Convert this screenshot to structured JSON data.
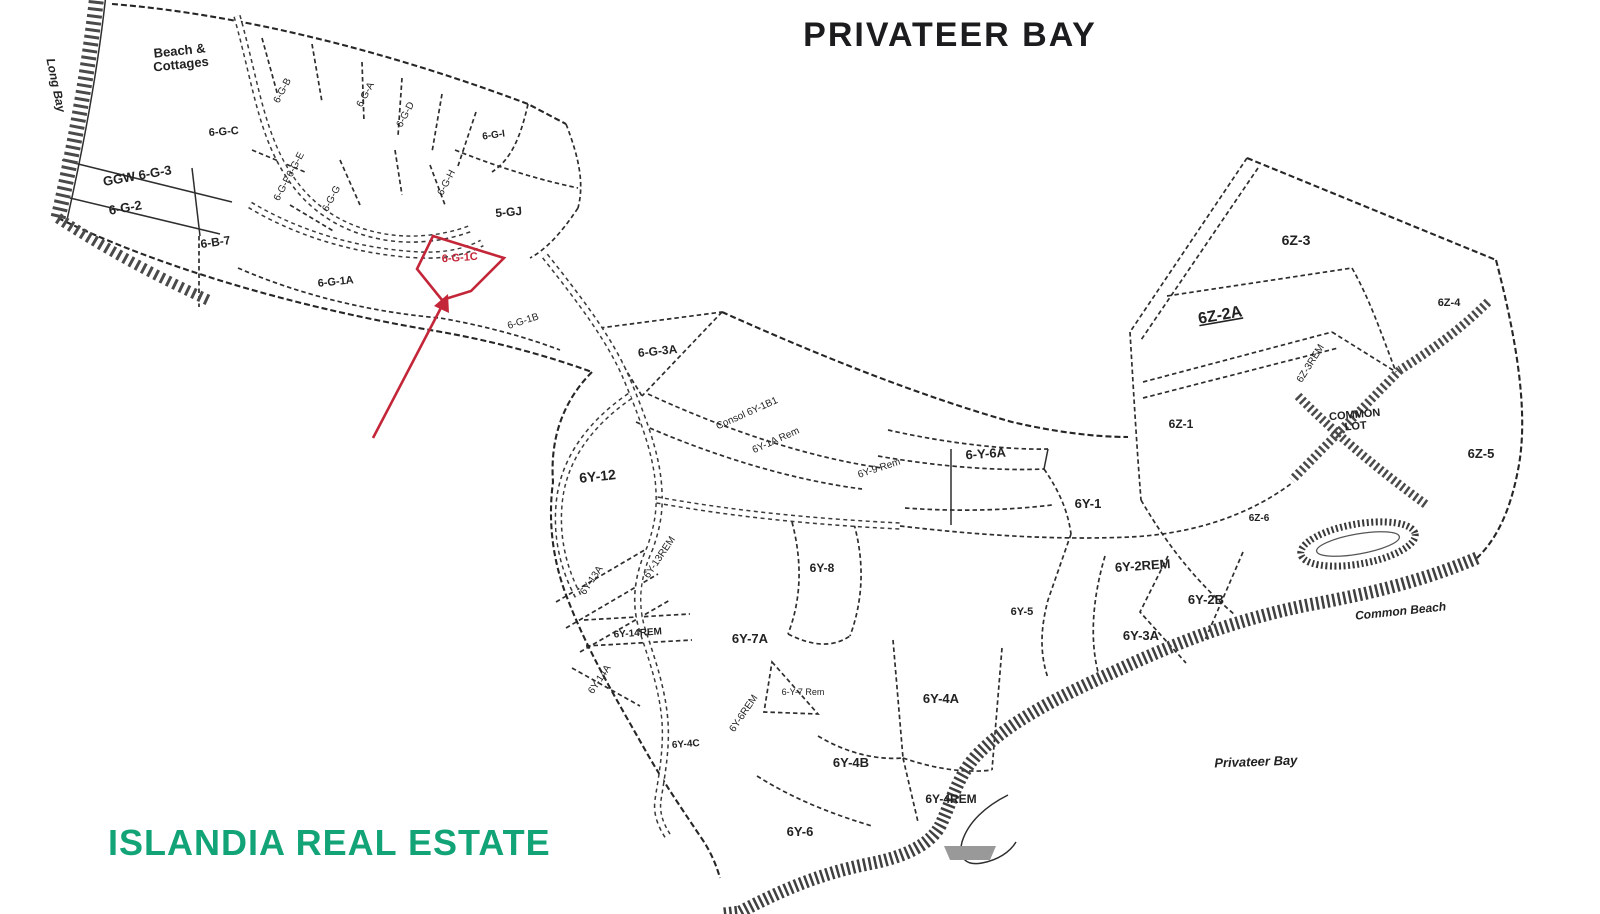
{
  "title": "PRIVATEER BAY",
  "credit": "ISLANDIA REAL ESTATE",
  "colors": {
    "credit_green": "#12A377",
    "highlight_red": "#C32638",
    "ink": "#222222"
  },
  "map": {
    "highlighted_lot": "6-G-1C",
    "labels": [
      {
        "text": "Long Bay",
        "x": 52,
        "y": 86,
        "rot": 78,
        "size": 12,
        "weight": 700,
        "style": "italic"
      },
      {
        "text": "Beach &\nCottages",
        "x": 180,
        "y": 55,
        "rot": -6,
        "size": 13,
        "weight": 700
      },
      {
        "text": "6-G-B",
        "x": 285,
        "y": 92,
        "rot": -62,
        "size": 10
      },
      {
        "text": "6-G-A",
        "x": 368,
        "y": 96,
        "rot": -62,
        "size": 10
      },
      {
        "text": "6-G-D",
        "x": 408,
        "y": 116,
        "rot": -62,
        "size": 10
      },
      {
        "text": "6-G-I",
        "x": 494,
        "y": 138,
        "rot": -8,
        "size": 10,
        "weight": 700
      },
      {
        "text": "6-G-C",
        "x": 224,
        "y": 135,
        "rot": -4,
        "size": 11,
        "weight": 700
      },
      {
        "text": "6-G-E",
        "x": 298,
        "y": 166,
        "rot": -62,
        "size": 10
      },
      {
        "text": "6-G-F",
        "x": 285,
        "y": 190,
        "rot": -62,
        "size": 10
      },
      {
        "text": "6-G-G",
        "x": 334,
        "y": 200,
        "rot": -62,
        "size": 10
      },
      {
        "text": "6-G-H",
        "x": 449,
        "y": 184,
        "rot": -62,
        "size": 10
      },
      {
        "text": "5-GJ",
        "x": 509,
        "y": 216,
        "rot": -5,
        "size": 12,
        "weight": 700
      },
      {
        "text": "GGW 6-G-3",
        "x": 138,
        "y": 180,
        "rot": -10,
        "size": 13,
        "weight": 700
      },
      {
        "text": "6-G-2",
        "x": 126,
        "y": 212,
        "rot": -10,
        "size": 13,
        "weight": 700
      },
      {
        "text": "6-B-7",
        "x": 216,
        "y": 246,
        "rot": -8,
        "size": 12,
        "weight": 700
      },
      {
        "text": "6-G-1A",
        "x": 336,
        "y": 285,
        "rot": -6,
        "size": 11,
        "weight": 700
      },
      {
        "text": "6-G-1C",
        "x": 460,
        "y": 261,
        "rot": -4,
        "size": 11,
        "weight": 700,
        "color": "#C32638"
      },
      {
        "text": "6-G-1B",
        "x": 524,
        "y": 324,
        "rot": -18,
        "size": 10
      },
      {
        "text": "6-G-3A",
        "x": 658,
        "y": 355,
        "rot": -6,
        "size": 12,
        "weight": 700
      },
      {
        "text": "Consol 6Y-1B1",
        "x": 748,
        "y": 416,
        "rot": -24,
        "size": 10
      },
      {
        "text": "6Y-1A Rem",
        "x": 777,
        "y": 443,
        "rot": -24,
        "size": 10
      },
      {
        "text": "6Y-9 Rem",
        "x": 880,
        "y": 471,
        "rot": -18,
        "size": 10
      },
      {
        "text": "6-Y-6A",
        "x": 986,
        "y": 458,
        "rot": -4,
        "size": 13,
        "weight": 700
      },
      {
        "text": "6Y-1",
        "x": 1088,
        "y": 508,
        "rot": 0,
        "size": 13,
        "weight": 700
      },
      {
        "text": "6Y-12",
        "x": 598,
        "y": 481,
        "rot": -6,
        "size": 14,
        "weight": 700
      },
      {
        "text": "6Y-13REM",
        "x": 662,
        "y": 559,
        "rot": -56,
        "size": 10
      },
      {
        "text": "6Y-13A",
        "x": 594,
        "y": 582,
        "rot": -56,
        "size": 10
      },
      {
        "text": "6Y-14REM",
        "x": 638,
        "y": 636,
        "rot": -4,
        "size": 10,
        "weight": 700
      },
      {
        "text": "6Y-14A",
        "x": 602,
        "y": 681,
        "rot": -56,
        "size": 10
      },
      {
        "text": "6Y-7A",
        "x": 750,
        "y": 643,
        "rot": 0,
        "size": 13,
        "weight": 700
      },
      {
        "text": "6Y-8",
        "x": 822,
        "y": 572,
        "rot": 0,
        "size": 12,
        "weight": 700
      },
      {
        "text": "6-Y-7 Rem",
        "x": 803,
        "y": 695,
        "rot": 0,
        "size": 9
      },
      {
        "text": "6Y-6REM",
        "x": 746,
        "y": 715,
        "rot": -56,
        "size": 10
      },
      {
        "text": "6Y-4C",
        "x": 686,
        "y": 747,
        "rot": -4,
        "size": 10,
        "weight": 700
      },
      {
        "text": "6Y-4A",
        "x": 941,
        "y": 703,
        "rot": 0,
        "size": 13,
        "weight": 700
      },
      {
        "text": "6Y-4B",
        "x": 851,
        "y": 767,
        "rot": 0,
        "size": 13,
        "weight": 700
      },
      {
        "text": "6Y-4REM",
        "x": 951,
        "y": 803,
        "rot": 0,
        "size": 12,
        "weight": 700
      },
      {
        "text": "6Y-6",
        "x": 800,
        "y": 836,
        "rot": 0,
        "size": 13,
        "weight": 700
      },
      {
        "text": "6Y-5",
        "x": 1022,
        "y": 615,
        "rot": 0,
        "size": 11,
        "weight": 700
      },
      {
        "text": "6Y-2REM",
        "x": 1143,
        "y": 570,
        "rot": -4,
        "size": 13,
        "weight": 700
      },
      {
        "text": "6Y-2B",
        "x": 1206,
        "y": 604,
        "rot": 0,
        "size": 13,
        "weight": 700
      },
      {
        "text": "6Y-3A",
        "x": 1141,
        "y": 640,
        "rot": 0,
        "size": 13,
        "weight": 700
      },
      {
        "text": "6Z-3",
        "x": 1296,
        "y": 245,
        "rot": 0,
        "size": 14,
        "weight": 700
      },
      {
        "text": "6Z-2A",
        "x": 1221,
        "y": 320,
        "rot": -10,
        "size": 16,
        "weight": 700,
        "underline": true
      },
      {
        "text": "6Z-3REM",
        "x": 1313,
        "y": 365,
        "rot": -58,
        "size": 10
      },
      {
        "text": "6Z-1",
        "x": 1181,
        "y": 428,
        "rot": 0,
        "size": 12,
        "weight": 700
      },
      {
        "text": "6Z-4",
        "x": 1449,
        "y": 306,
        "rot": 0,
        "size": 11,
        "weight": 700
      },
      {
        "text": "6Z-6",
        "x": 1259,
        "y": 521,
        "rot": 0,
        "size": 10,
        "weight": 700
      },
      {
        "text": "COMMON\nLOT",
        "x": 1355,
        "y": 418,
        "rot": -5,
        "size": 11,
        "weight": 700
      },
      {
        "text": "6Z-5",
        "x": 1481,
        "y": 458,
        "rot": 0,
        "size": 13,
        "weight": 700
      },
      {
        "text": "Common Beach",
        "x": 1401,
        "y": 615,
        "rot": -6,
        "size": 12,
        "weight": 700,
        "style": "italic"
      },
      {
        "text": "Privateer Bay",
        "x": 1256,
        "y": 766,
        "rot": -2,
        "size": 13,
        "weight": 700,
        "style": "italic"
      }
    ]
  }
}
